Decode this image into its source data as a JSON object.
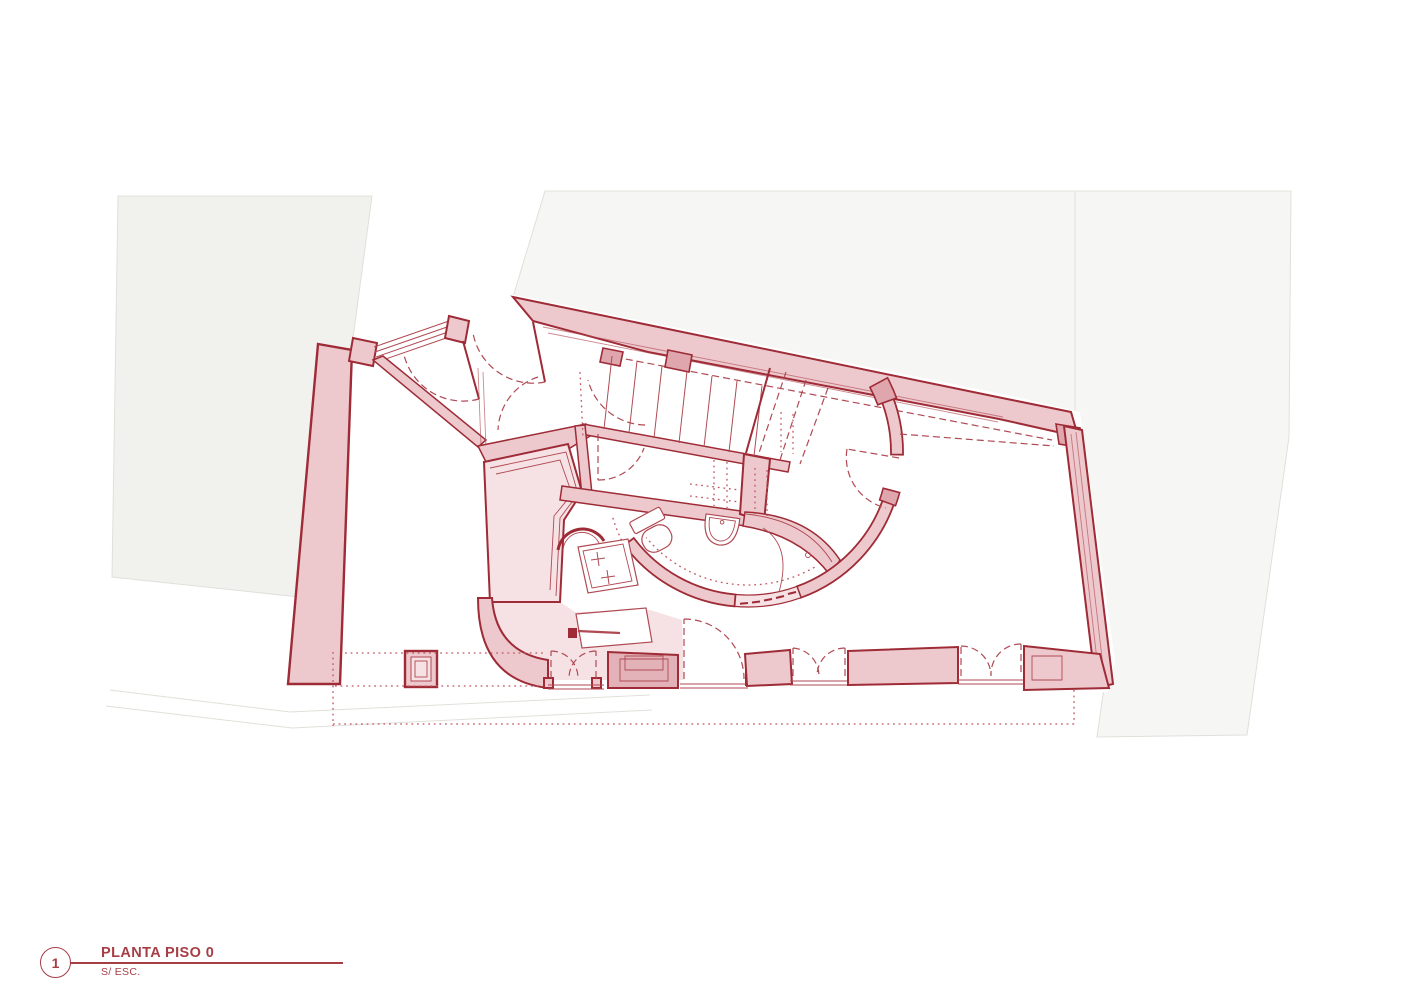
{
  "title_block": {
    "figure_number": "1",
    "title": "PLANTA PISO 0",
    "subtitle": "S/ ESC."
  },
  "colors": {
    "background": "#ffffff",
    "site_fill_left": "#f1f1ee",
    "site_fill_right": "#f6f6f4",
    "site_stroke": "#e0e0da",
    "wall_fill": "#edc9ce",
    "wall_stroke": "#9e2b36",
    "accent_block": "#dfa6ae",
    "planter_fill": "#e3b2b9",
    "room_tint": "#f6e1e4",
    "line_red": "#b04a53",
    "dotted_red": "#c25762",
    "title_red": "#a63e46"
  },
  "plan": {
    "drawing_type": "architectural floor plan",
    "floor": "Piso 0",
    "scale_note": "sem escala (not to scale)",
    "elements": [
      "site-boundary-parcels",
      "party-wall",
      "north-facade-wall",
      "entry-glazing",
      "entry-door-swing",
      "staircase",
      "storage-room",
      "technical-room",
      "curved-bathroom-wall",
      "arched-doorway",
      "toilet",
      "washbasin",
      "shower",
      "shower-tray",
      "cabinet",
      "column",
      "double-leaf-doors",
      "window-sills",
      "projection-dotted-lines"
    ]
  }
}
